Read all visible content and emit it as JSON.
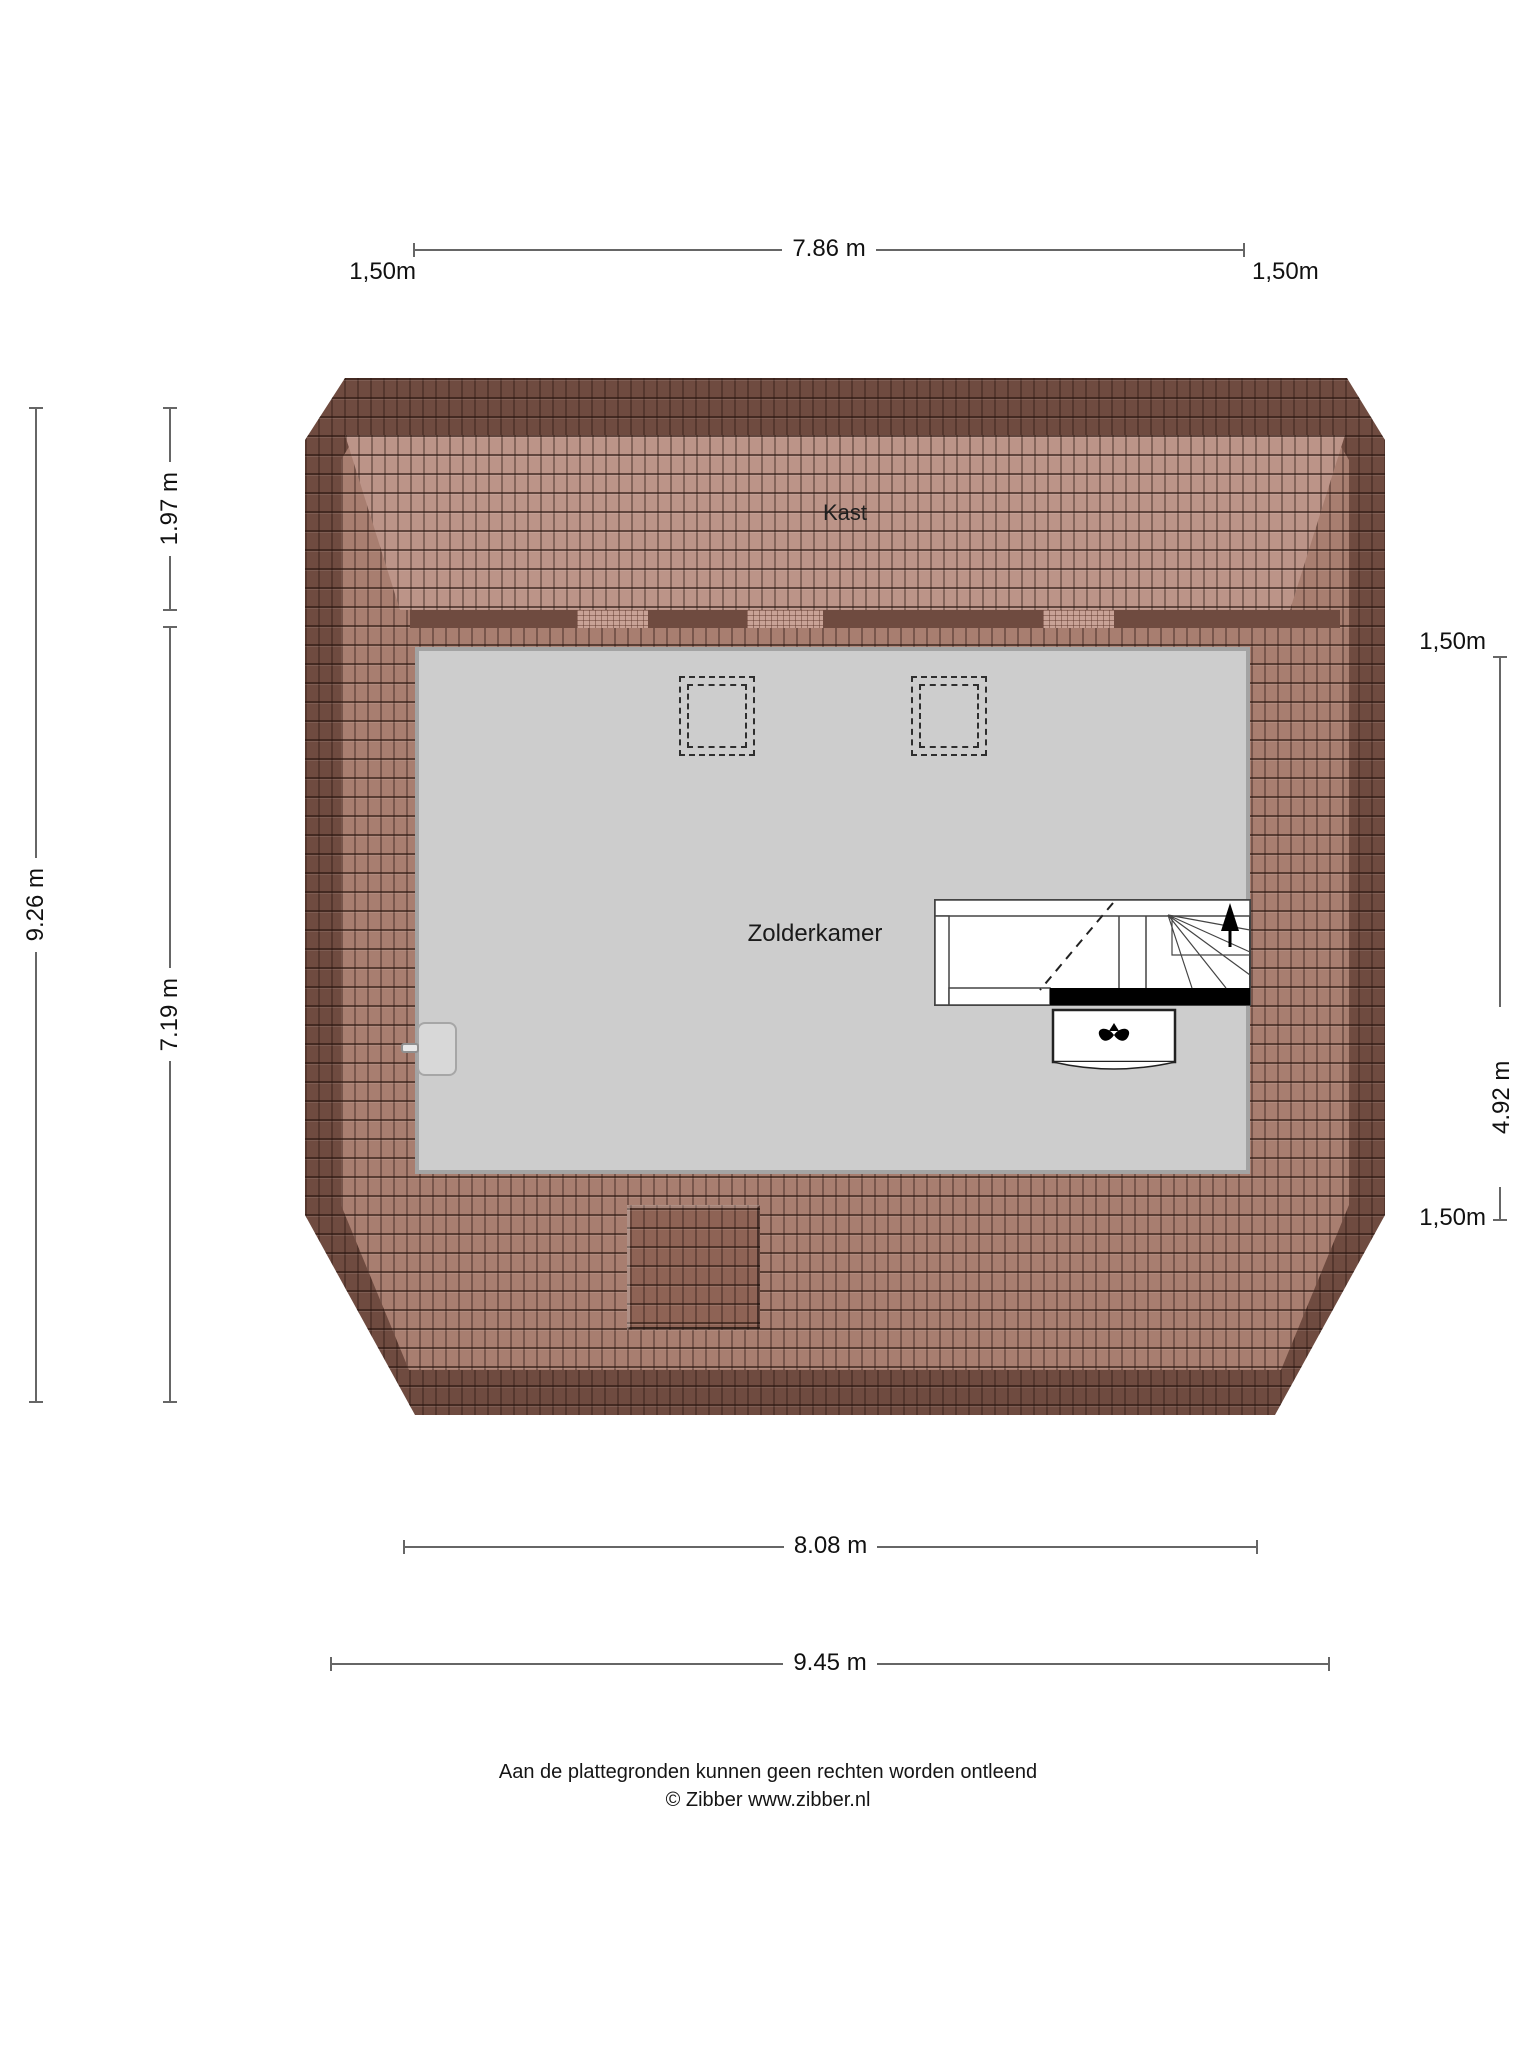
{
  "dimensions": {
    "top": {
      "label": "7.86 m",
      "left_offset": "1,50m",
      "right_offset": "1,50m"
    },
    "left": {
      "total": "9.26 m",
      "kast_depth": "1.97 m",
      "room_depth": "7.19 m"
    },
    "right": {
      "top_offset": "1,50m",
      "room_depth": "4.92 m",
      "bottom_offset": "1,50m"
    },
    "bottom": {
      "inner": "8.08 m",
      "outer": "9.45 m"
    }
  },
  "rooms": {
    "kast_label": "Kast",
    "attic_label": "Zolderkamer"
  },
  "footer": {
    "line1": "Aan de plattegronden kunnen geen rechten worden ontleend",
    "line2": "© Zibber www.zibber.nl"
  },
  "colors": {
    "roof_dark": "#6F4B40",
    "roof_mid": "#A87E70",
    "roof_light": "#BC9488",
    "roof_inset": "#8E6355",
    "vent_light": "#C8A296",
    "room_gray": "#CDCDCD",
    "wall_gray": "#A3A3A3",
    "dim_line": "#666666",
    "ink": "#111111"
  }
}
